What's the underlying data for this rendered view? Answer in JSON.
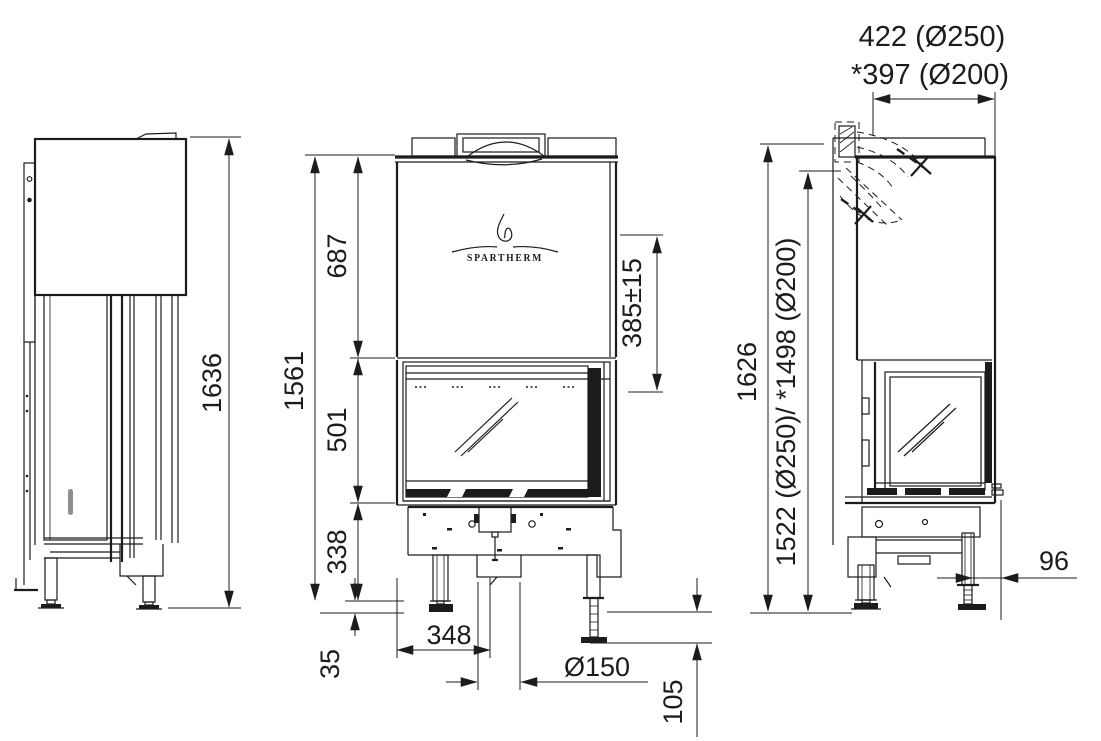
{
  "meta": {
    "type": "fireplace-insert-technical-drawing",
    "views": [
      "left-side-view",
      "front-view",
      "right-side-view"
    ]
  },
  "colors": {
    "line": "#1c1c1c",
    "background": "#ffffff",
    "handle_gray": "#8f8f8f"
  },
  "drawing": {
    "brand_logo_text": "SPARTHERM",
    "dimensions": {
      "left_view_overall_height": "1636",
      "front_view_overall_height": "1561",
      "front_view_hood_height": "687",
      "front_view_glass_height": "501",
      "front_view_base_height": "338",
      "front_view_foot_min": "35",
      "front_view_intake_offset": "348",
      "front_view_intake_diameter": "Ø150",
      "front_view_foot_adjust": "105",
      "front_view_top_to_glass": "385±15",
      "right_view_flue_offset_line1": "422 (Ø250)",
      "right_view_flue_offset_line2": "*397 (Ø200)",
      "right_view_overall_height": "1626",
      "right_view_flue_axis_height": "1522 (Ø250)/ *1498 (Ø200)",
      "right_view_leg_setback": "96"
    }
  }
}
